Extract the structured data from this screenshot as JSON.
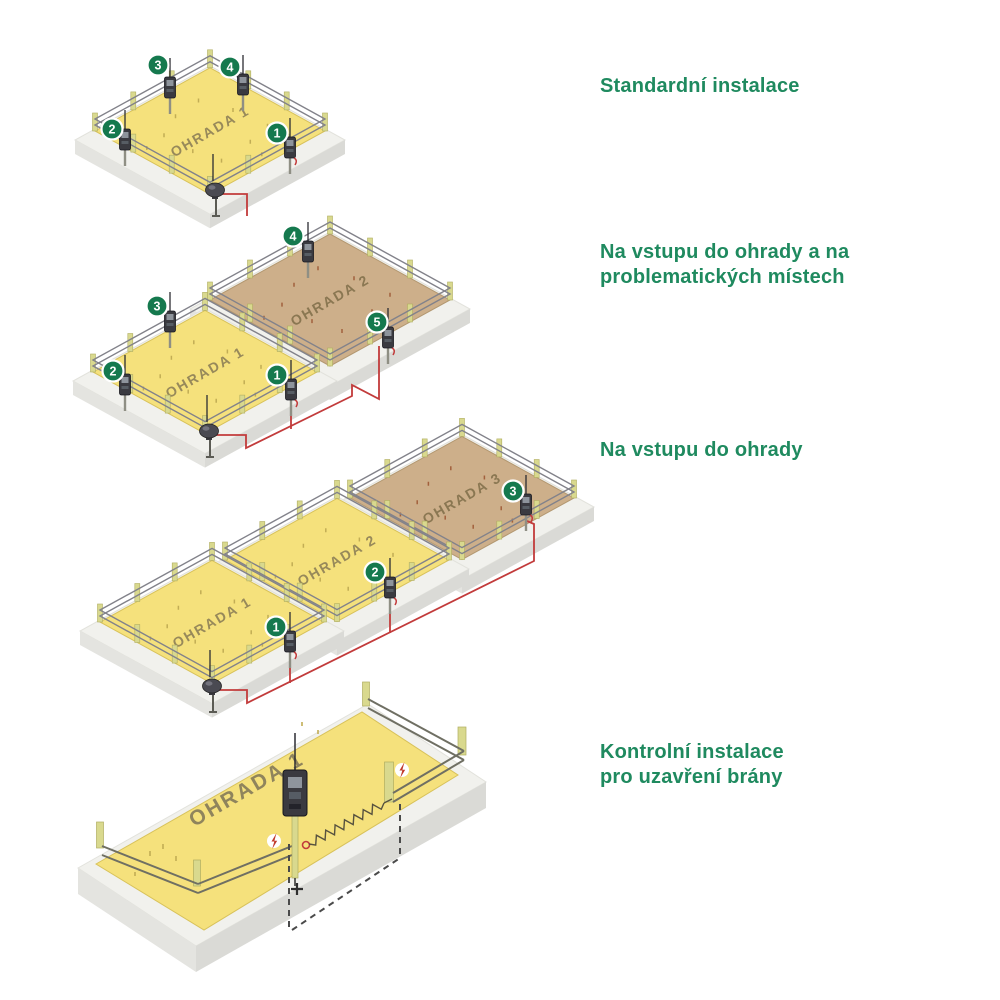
{
  "colors": {
    "title_green": "#1F8A5F",
    "badge_green": "#15794E",
    "field_yellow": "#F5E17C",
    "field_yellow_edge": "#D8C25A",
    "field_tan": "#CDAF8A",
    "field_tan_edge": "#B39871",
    "tuft_yellow": "#C2AD55",
    "tuft_tan": "#A2603C",
    "slab_top": "#F1F1ED",
    "slab_left": "#E4E4E0",
    "slab_right": "#DADAD6",
    "post": "#D9D98E",
    "post_edge": "#B0AD60",
    "wire_gray": "#82828A",
    "red_wire": "#C23B3B",
    "device_dark": "#3A3A40",
    "label_on_yellow": "#97895A",
    "label_on_tan": "#8A7752",
    "dash_gray": "#4A4A4A"
  },
  "sections": [
    {
      "id": "standard-installation",
      "title_lines": [
        "Standardní instalace"
      ]
    },
    {
      "id": "entrance-and-problem-spots",
      "title_lines": [
        "Na vstupu do ohrady a na",
        "problematických místech"
      ]
    },
    {
      "id": "entrance-only",
      "title_lines": [
        "Na vstupu do ohrady"
      ]
    },
    {
      "id": "gate-closing-control",
      "title_lines": [
        "Kontrolní instalace",
        "pro uzavření brány"
      ]
    }
  ],
  "scenes": [
    {
      "id": "standard-installation",
      "paddocks": [
        {
          "label": "OHRADA 1",
          "cx": 210,
          "cy": 131,
          "hw": 115,
          "field": "yellow"
        }
      ],
      "devices": [
        {
          "x": 170,
          "y": 88
        },
        {
          "x": 243,
          "y": 85
        },
        {
          "x": 125,
          "y": 140
        },
        {
          "x": 290,
          "y": 148,
          "red": true
        }
      ],
      "badges": [
        {
          "n": "3",
          "x": 158,
          "y": 65
        },
        {
          "n": "4",
          "x": 230,
          "y": 67
        },
        {
          "n": "2",
          "x": 112,
          "y": 129
        },
        {
          "n": "1",
          "x": 277,
          "y": 133
        }
      ],
      "energizer": {
        "x": 215,
        "y": 190
      },
      "red_paths": [
        "M221,194 L247,194 L247,216"
      ]
    },
    {
      "id": "entrance-and-problem-spots",
      "paddocks": [
        {
          "label": "OHRADA 1",
          "cx": 205,
          "cy": 372,
          "hw": 112,
          "field": "yellow"
        },
        {
          "label": "OHRADA 2",
          "cx": 330,
          "cy": 300,
          "hw": 120,
          "field": "tan"
        }
      ],
      "devices": [
        {
          "x": 308,
          "y": 252
        },
        {
          "x": 170,
          "y": 322
        },
        {
          "x": 388,
          "y": 338,
          "red": true
        },
        {
          "x": 125,
          "y": 385
        },
        {
          "x": 291,
          "y": 390,
          "red": true
        }
      ],
      "badges": [
        {
          "n": "4",
          "x": 293,
          "y": 236
        },
        {
          "n": "3",
          "x": 157,
          "y": 306
        },
        {
          "n": "5",
          "x": 377,
          "y": 322
        },
        {
          "n": "2",
          "x": 113,
          "y": 371
        },
        {
          "n": "1",
          "x": 277,
          "y": 375
        }
      ],
      "energizer": {
        "x": 209,
        "y": 431
      },
      "red_paths": [
        "M215,435 L246,435 L246,448 L352,396 L352,385 L379,399 L379,346",
        "M291,416 L291,429"
      ]
    },
    {
      "id": "entrance-only",
      "paddocks": [
        {
          "label": "OHRADA 1",
          "cx": 212,
          "cy": 622,
          "hw": 112,
          "field": "yellow"
        },
        {
          "label": "OHRADA 2",
          "cx": 337,
          "cy": 560,
          "hw": 112,
          "field": "yellow"
        },
        {
          "label": "OHRADA 3",
          "cx": 462,
          "cy": 498,
          "hw": 112,
          "field": "tan"
        }
      ],
      "devices": [
        {
          "x": 290,
          "y": 642,
          "red": true
        },
        {
          "x": 390,
          "y": 588,
          "red": true
        },
        {
          "x": 526,
          "y": 505,
          "red": true
        }
      ],
      "badges": [
        {
          "n": "1",
          "x": 276,
          "y": 627
        },
        {
          "n": "2",
          "x": 375,
          "y": 572
        },
        {
          "n": "3",
          "x": 513,
          "y": 491
        }
      ],
      "energizer": {
        "x": 212,
        "y": 686
      },
      "red_paths": [
        "M218,690 L247,690 L247,703 L534,561 L534,524 L527,521",
        "M290,668 L290,683",
        "M390,614 L390,633"
      ]
    },
    {
      "id": "gate-closing-control",
      "static": true,
      "paddocks": [
        {
          "label": "OHRADA 1",
          "field": "yellow"
        }
      ],
      "icons": [
        "voltage-arrow-icon",
        "voltage-arrow-icon",
        "ground-terminal-icon"
      ]
    }
  ]
}
